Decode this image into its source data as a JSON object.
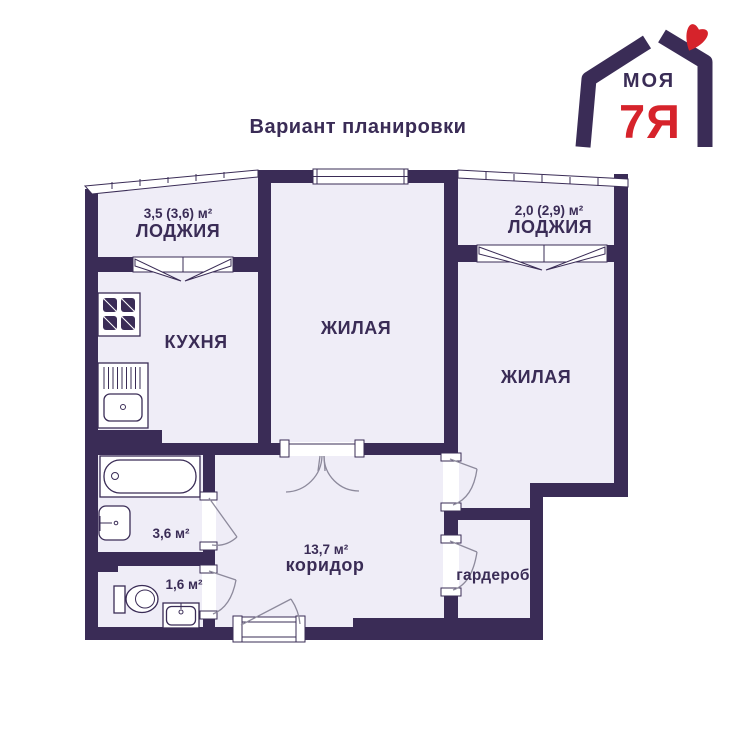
{
  "title": "Вариант планировки",
  "logo": {
    "word_top": "МОЯ",
    "word_bottom": "7Я"
  },
  "rooms": {
    "loggia_left": {
      "area": "3,5 (3,6) м²",
      "name": "ЛОДЖИЯ"
    },
    "kitchen": {
      "name": "КУХНЯ"
    },
    "living_center": {
      "name": "ЖИЛАЯ"
    },
    "loggia_right": {
      "area": "2,0 (2,9) м²",
      "name": "ЛОДЖИЯ"
    },
    "living_right": {
      "name": "ЖИЛАЯ"
    },
    "bathroom": {
      "area": "3,6 м²"
    },
    "toilet": {
      "area": "1,6 м²"
    },
    "corridor": {
      "area": "13,7 м²",
      "name": "коридор"
    },
    "wardrobe": {
      "name": "гардероб"
    }
  },
  "colors": {
    "wall": "#3A2C56",
    "room_fill": "#EFEDF7",
    "logo_red": "#D6232B",
    "arc_line": "#8D8A9C",
    "background": "#FFFFFF"
  }
}
